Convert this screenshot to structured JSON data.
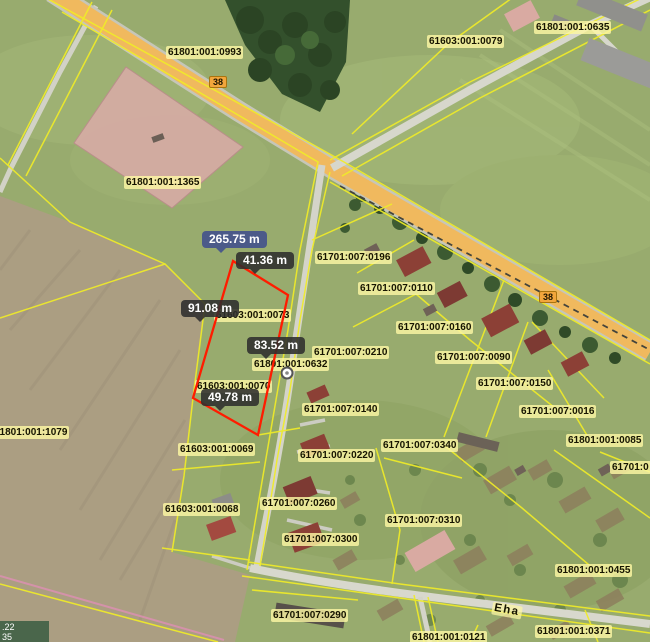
{
  "parcel_labels": [
    "61801:001:0993",
    "61603:001:0079",
    "61801:001:0635",
    "61801:001:1365",
    "61701:007:0196",
    "61701:007:0110",
    "61701:007:0160",
    "61701:007:0210",
    "61701:007:0090",
    "61801:001:0632",
    "61701:007:0150",
    "61701:007:0140",
    "61701:007:0016",
    "61801:001:1079",
    "61603:001:0069",
    "61701:007:0220",
    "61701:007:0340",
    "61801:001:0085",
    "61701:0",
    "61603:001:0068",
    "61701:007:0260",
    "61701:007:0310",
    "61701:007:0300",
    "61801:001:0455",
    "61701:007:0290",
    "61801:001:0371",
    "61801:001:0121",
    "61603:001:0073",
    "61603:001:0070"
  ],
  "road_badges": [
    "38",
    "38"
  ],
  "street_name": "Eha",
  "measurement": {
    "total": "265.75 m",
    "side_top": "41.36 m",
    "side_left": "91.08 m",
    "side_right": "83.52 m",
    "side_bottom": "49.78 m"
  },
  "coordinate_readout": {
    "line1": ".22",
    "line2": "35"
  },
  "colors": {
    "cadastral_boundary": "#f0ec28",
    "measurement_line": "#ff1c00",
    "total_badge_bg": "#48568a",
    "segment_badge_bg": "#2d2d2d",
    "label_chip_bg": "#fdf7a3",
    "highway_fill": "#f0b95e",
    "highlight_parcel_fill": "#d8aba6"
  }
}
